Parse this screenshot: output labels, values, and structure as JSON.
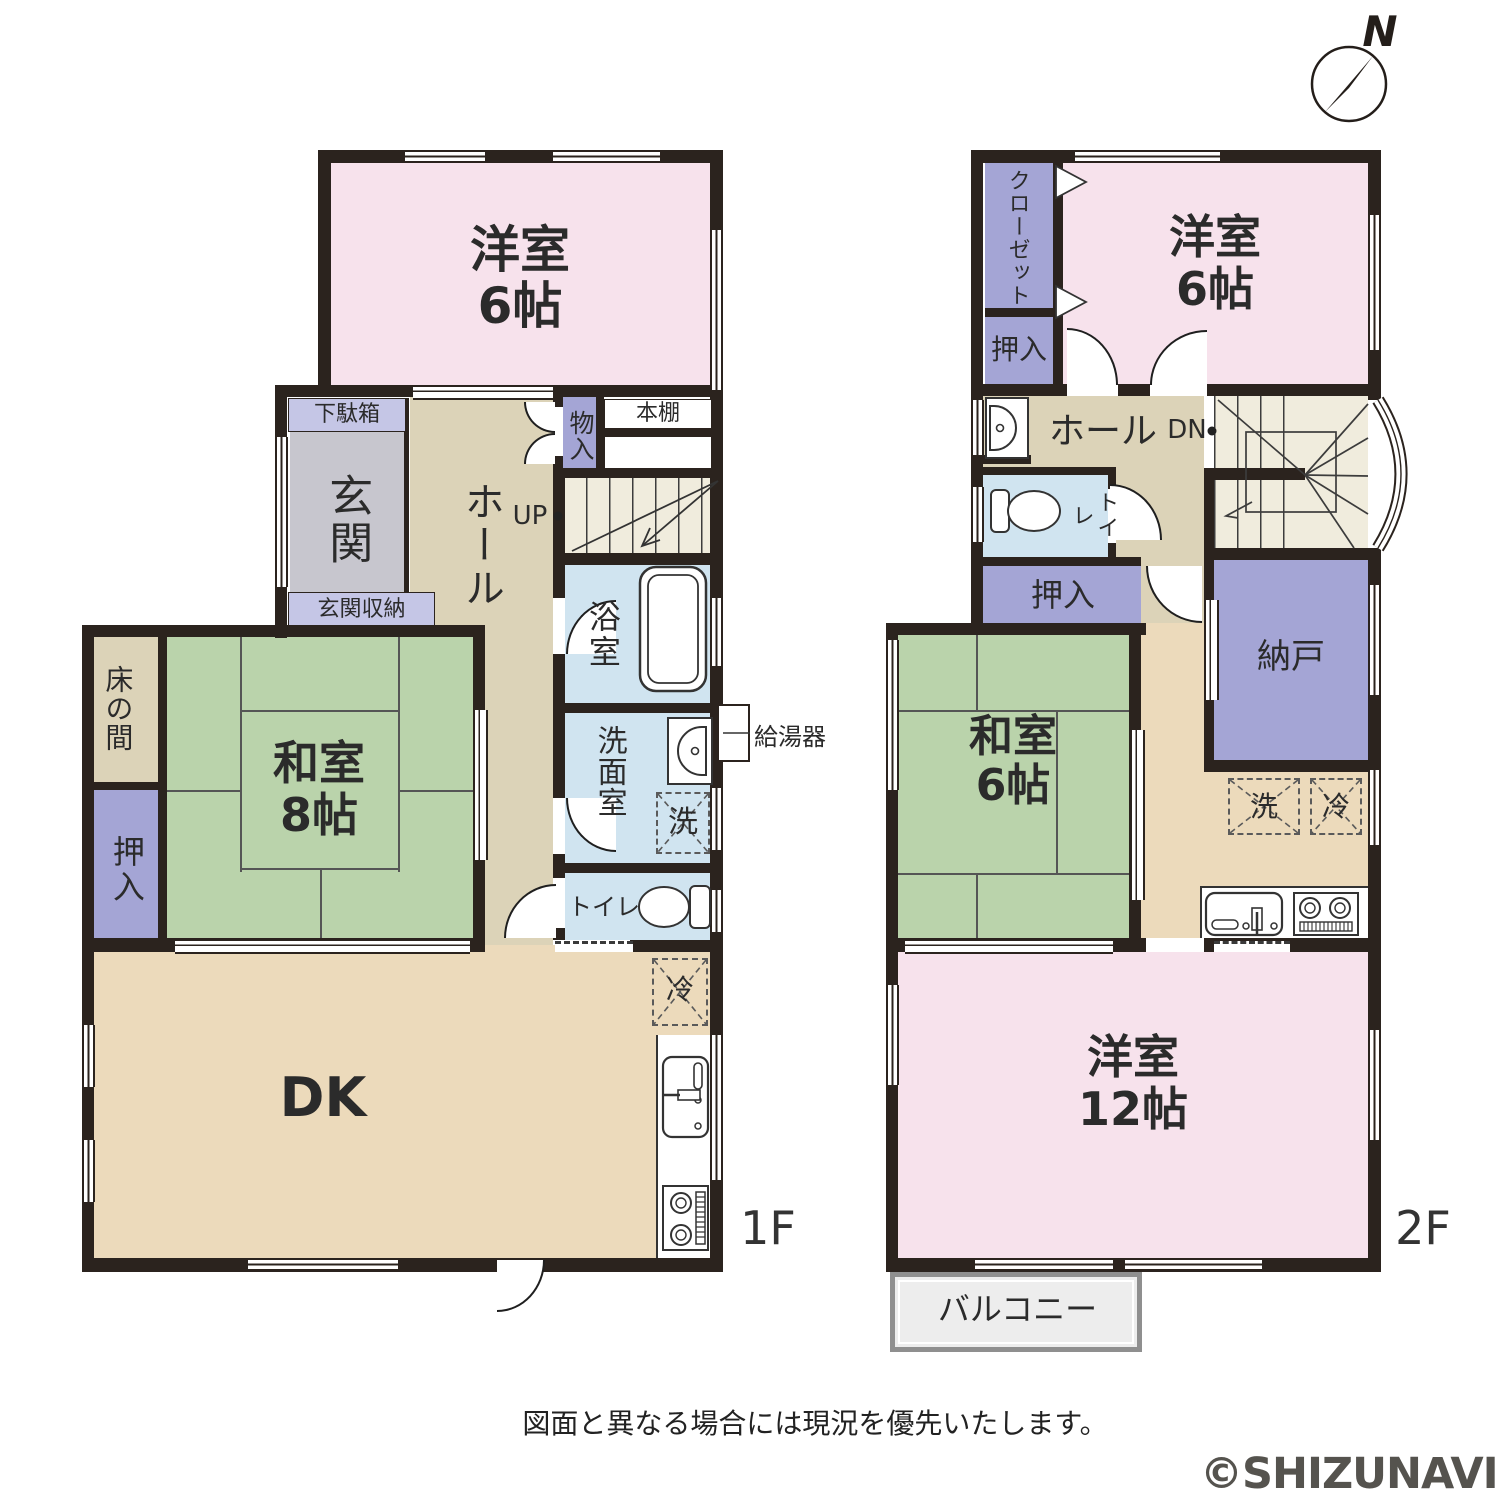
{
  "compass": {
    "north": "N"
  },
  "f1": {
    "floor": "1F",
    "youshitsu": "洋室\n6帖",
    "getabako": "下駄箱",
    "genkan": "玄関",
    "genkan_shuno": "玄関収納",
    "hall": "ホール",
    "monoire": "物入",
    "hondana": "本棚",
    "up": "UP",
    "yokushitsu": "浴室",
    "senmenshitsu": "洗面室",
    "sentaku": "洗",
    "kyutoki": "給湯器",
    "toilet": "トイレ",
    "tokonoma": "床の間",
    "washitsu": "和室\n8帖",
    "oshiire": "押入",
    "dk": "DK",
    "rei": "冷"
  },
  "f2": {
    "floor": "2F",
    "closet": "クローゼット",
    "youshitsu6": "洋室\n6帖",
    "oshiire_top": "押入",
    "hall": "ホール",
    "dn": "DN",
    "toilet": "トイレ",
    "oshiire": "押入",
    "nando": "納戸",
    "washitsu": "和室\n6帖",
    "sentaku": "洗",
    "rei": "冷",
    "youshitsu12": "洋室\n12帖",
    "balcony": "バルコニー"
  },
  "footer": {
    "disclaimer": "図面と異なる場合には現況を優先いたします。",
    "watermark": "©SHIZUNAVI"
  },
  "colors": {
    "wall": "#2b231e",
    "western_room": "#f7e2ec",
    "tatami_room": "#bad3ab",
    "hall": "#dcd3b8",
    "dk": "#ecdabb",
    "wet_area": "#d0e4f0",
    "closet": "#a4a5d5",
    "entry_storage": "#c5c6e6",
    "genkan": "#c7c6ce",
    "stairs": "#f0ecdd"
  }
}
